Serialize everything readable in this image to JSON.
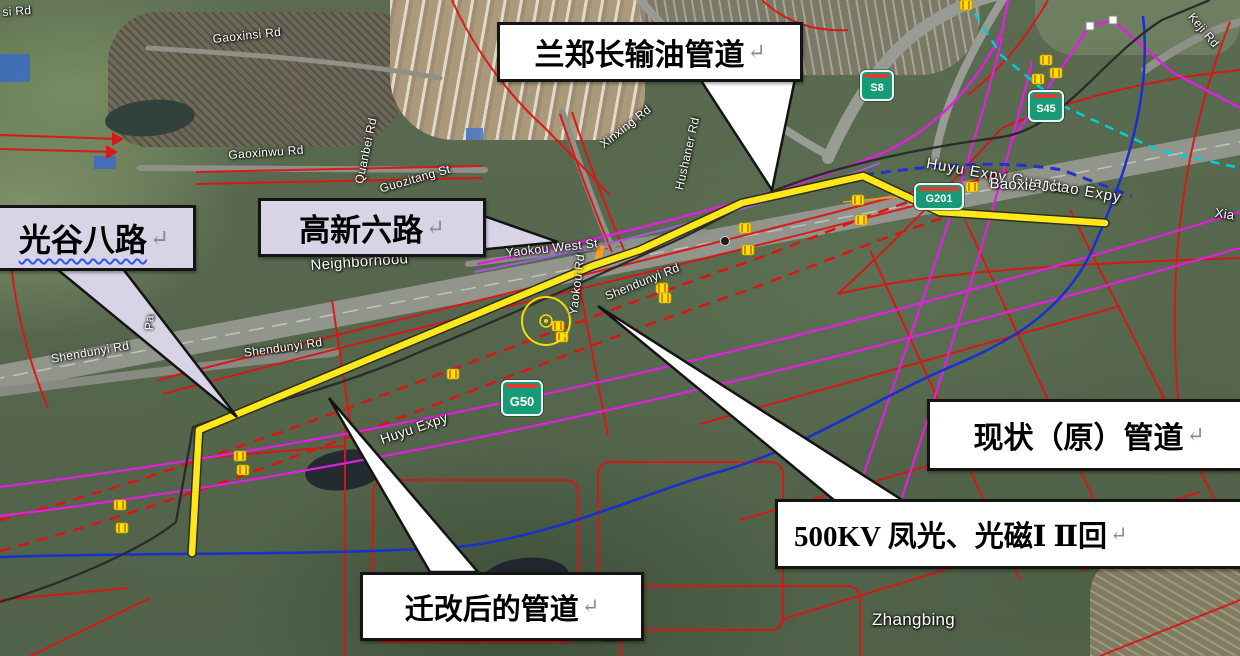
{
  "canvas": {
    "width": 1240,
    "height": 656
  },
  "colors": {
    "relocated_pipeline_yellow": "#ffe81a",
    "current_pipeline_black": "#2b2b2b",
    "planning_road_red": "#dd1414",
    "power_line_dashed_red": "#dd1414",
    "magenta_line": "#e020e0",
    "purple_line": "#9a5fd6",
    "blue_line": "#1a2fd0",
    "blue_dashed": "#2233cc",
    "cyan_dashed": "#00cfd6",
    "callout_white": "#ffffff",
    "callout_lavender": "#d9d3e6",
    "marker_yellow": "#ffe400",
    "shield_green": "#169b76"
  },
  "callouts": [
    {
      "id": "lanzhengchang-pipeline",
      "text": "兰郑长输油管道",
      "return_mark": "↵"
    },
    {
      "id": "guanggu-8th-road",
      "text": "光谷八路",
      "return_mark": "↵"
    },
    {
      "id": "gaoxin-6th-road",
      "text": "高新六路",
      "return_mark": "↵"
    },
    {
      "id": "current-original-pipeline",
      "text": "现状（原）管道",
      "return_mark": "↵"
    },
    {
      "id": "500kv-power-lines",
      "text": "500KV 凤光、光磁Ⅰ Ⅱ回",
      "return_mark": "↵"
    },
    {
      "id": "relocated-pipeline",
      "text": "迁改后的管道",
      "return_mark": "↵"
    }
  ],
  "map_labels": [
    {
      "id": "gaoxinsi-rd",
      "text": "Gaoxinsi Rd"
    },
    {
      "id": "si-rd-partial",
      "text": "si Rd"
    },
    {
      "id": "gaoxinwu-rd",
      "text": "Gaoxinwu Rd"
    },
    {
      "id": "quanbei-rd",
      "text": "Quanbei Rd"
    },
    {
      "id": "guozitang-st",
      "text": "Guozitang St"
    },
    {
      "id": "xinxing-rd",
      "text": "Xinxing Rd"
    },
    {
      "id": "hushaner-rd",
      "text": "Hushaner Rd"
    },
    {
      "id": "neighborhood",
      "text": "Neighborhood"
    },
    {
      "id": "yaokou-west-st",
      "text": "Yaokou West St"
    },
    {
      "id": "yaokou-rd",
      "text": "Yaokou Rd"
    },
    {
      "id": "shendunyi-rd-center",
      "text": "Shendunyi Rd"
    },
    {
      "id": "shendunyi-rd-left",
      "text": "Shendunyi Rd"
    },
    {
      "id": "shendunyi-rd-mid",
      "text": "Shendunyi Rd"
    },
    {
      "id": "pa-partial",
      "text": "Pa"
    },
    {
      "id": "huyu-expy",
      "text": "Huyu Expy"
    },
    {
      "id": "huyu-guanbao-expy",
      "text": "Huyu Expy Guanbao Expy"
    },
    {
      "id": "baoxie-jct",
      "text": "Baoxie Jct"
    },
    {
      "id": "xia-partial",
      "text": "Xia"
    },
    {
      "id": "keji-rd",
      "text": "Keji Rd"
    },
    {
      "id": "zhangbing",
      "text": "Zhangbing"
    }
  ],
  "shields": [
    {
      "label": "S8"
    },
    {
      "label": "S45"
    },
    {
      "label": "G201"
    },
    {
      "label": "G50"
    }
  ]
}
